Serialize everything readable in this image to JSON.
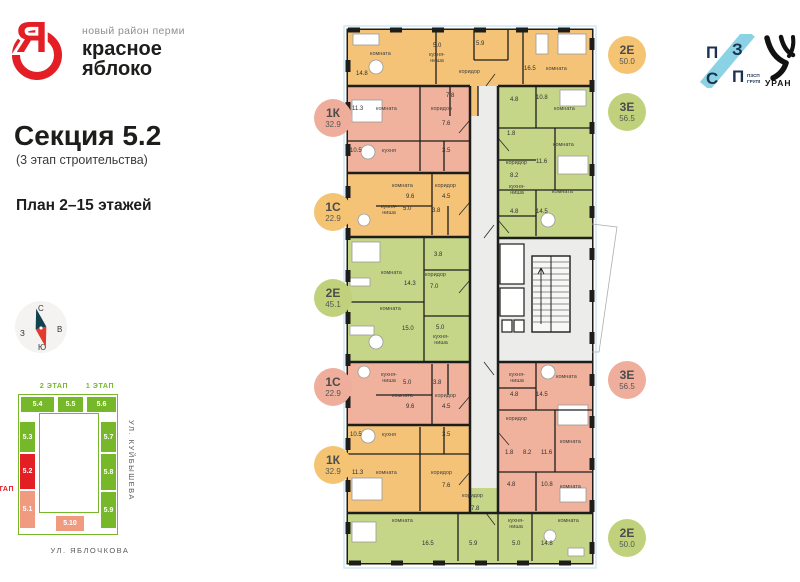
{
  "brand": {
    "logo_letter": "Я",
    "tagline": "новый район перми",
    "name_line1": "красное",
    "name_line2": "яблоко",
    "accent_color": "#e31e24"
  },
  "section": {
    "title": "Секция 5.2",
    "subtitle": "(3 этап строительства)",
    "plan_label": "План 2–15 этажей"
  },
  "compass": {
    "n": "С",
    "e": "В",
    "s": "Ю",
    "w": "З"
  },
  "partners": {
    "pzsp": {
      "tl": "П",
      "tr": "З",
      "bl": "С",
      "br": "П",
      "caption_line1": "ПЗСП",
      "caption_line2": "ГРУПП",
      "band_color": "#8ad2e4",
      "letter_color": "#1c3250"
    },
    "uran": {
      "name": "УРАН"
    }
  },
  "site_plan": {
    "stage2_label": "2 ЭТАП",
    "stage1_label": "1 ЭТАП",
    "stage3_label": "3 ЭТАП",
    "street_right": "УЛ. КУЙБЫШЕВА",
    "street_bottom": "УЛ. ЯБЛОЧКОВА",
    "blocks": [
      {
        "label": "5.4",
        "color": "#76b82a"
      },
      {
        "label": "5.5",
        "color": "#76b82a"
      },
      {
        "label": "5.6",
        "color": "#76b82a"
      },
      {
        "label": "5.3",
        "color": "#76b82a"
      },
      {
        "label": "5.7",
        "color": "#76b82a"
      },
      {
        "label": "5.2",
        "color": "#e31e24"
      },
      {
        "label": "5.8",
        "color": "#76b82a"
      },
      {
        "label": "5.1",
        "color": "#f09a80"
      },
      {
        "label": "5.9",
        "color": "#76b82a"
      },
      {
        "label": "5.10",
        "color": "#f09a80"
      }
    ]
  },
  "badges": {
    "left": [
      {
        "code": "1К",
        "area": "32.9",
        "color": "#efad9b"
      },
      {
        "code": "1С",
        "area": "22.9",
        "color": "#f4c472"
      },
      {
        "code": "2Е",
        "area": "45.1",
        "color": "#bfd27b"
      },
      {
        "code": "1С",
        "area": "22.9",
        "color": "#efad9b"
      },
      {
        "code": "1К",
        "area": "32.9",
        "color": "#f4c472"
      }
    ],
    "right": [
      {
        "code": "2Е",
        "area": "50.0",
        "color": "#f4c472"
      },
      {
        "code": "3Е",
        "area": "56.5",
        "color": "#bfd27b"
      },
      {
        "code": "3Е",
        "area": "56.5",
        "color": "#efad9b"
      },
      {
        "code": "2Е",
        "area": "50.0",
        "color": "#bfd27b"
      }
    ]
  },
  "floor_plan": {
    "colors": {
      "orange": "#f4c377",
      "salmon": "#f0b29c",
      "green": "#c5d689",
      "core": "#ececea"
    },
    "apartments": [
      {
        "code": "2Е",
        "total": "50.0",
        "rooms": [
          {
            "name": "комната",
            "area": "14.8"
          },
          {
            "name": "кухня-ниша",
            "area": "5.0"
          },
          {
            "name": "с/у",
            "area": "5.9"
          },
          {
            "name": "коридор",
            "area": "7.8"
          },
          {
            "name": "комната",
            "area": "16.5"
          }
        ]
      },
      {
        "code": "1К",
        "total": "32.9",
        "rooms": [
          {
            "name": "комната",
            "area": "11.3"
          },
          {
            "name": "коридор",
            "area": "7.6"
          },
          {
            "name": "кухня",
            "area": "10.5"
          },
          {
            "name": "с/у",
            "area": "3.5"
          }
        ]
      },
      {
        "code": "1С",
        "total": "22.9",
        "rooms": [
          {
            "name": "комната",
            "area": "9.6"
          },
          {
            "name": "коридор",
            "area": "4.5"
          },
          {
            "name": "кухня-ниша",
            "area": "5.0"
          },
          {
            "name": "с/у",
            "area": "3.8"
          }
        ]
      },
      {
        "code": "2Е",
        "total": "45.1",
        "rooms": [
          {
            "name": "комната",
            "area": "14.3"
          },
          {
            "name": "с/у",
            "area": "3.8"
          },
          {
            "name": "коридор",
            "area": "7.0"
          },
          {
            "name": "комната",
            "area": "15.0"
          },
          {
            "name": "кухня-ниша",
            "area": "5.0"
          }
        ]
      },
      {
        "code": "1С",
        "total": "22.9",
        "rooms": [
          {
            "name": "кухня-ниша",
            "area": "5.0"
          },
          {
            "name": "с/у",
            "area": "3.8"
          },
          {
            "name": "комната",
            "area": "9.6"
          },
          {
            "name": "коридор",
            "area": "4.5"
          }
        ]
      },
      {
        "code": "1К",
        "total": "32.9",
        "rooms": [
          {
            "name": "кухня",
            "area": "10.5"
          },
          {
            "name": "с/у",
            "area": "3.5"
          },
          {
            "name": "комната",
            "area": "11.3"
          },
          {
            "name": "коридор",
            "area": "7.6"
          }
        ]
      },
      {
        "code": "2Е",
        "total": "50.0",
        "rooms": [
          {
            "name": "комната",
            "area": "16.5"
          },
          {
            "name": "с/у",
            "area": "5.9"
          },
          {
            "name": "коридор",
            "area": "7.8"
          },
          {
            "name": "кухня-ниша",
            "area": "5.0"
          },
          {
            "name": "комната",
            "area": "14.8"
          }
        ]
      },
      {
        "code": "3Е",
        "total": "56.5",
        "rooms": [
          {
            "name": "с/у",
            "area": "4.8"
          },
          {
            "name": "комната",
            "area": "10.8"
          },
          {
            "name": "с/у",
            "area": "1.8"
          },
          {
            "name": "комната",
            "area": "11.6"
          },
          {
            "name": "коридор",
            "area": "8.2"
          },
          {
            "name": "кухня-ниша",
            "area": "4.8"
          },
          {
            "name": "комната",
            "area": "14.5"
          }
        ]
      },
      {
        "code": "3Е",
        "total": "56.5",
        "rooms": [
          {
            "name": "кухня-ниша",
            "area": "4.8"
          },
          {
            "name": "комната",
            "area": "14.5"
          },
          {
            "name": "коридор",
            "area": "8.2"
          },
          {
            "name": "комната",
            "area": "11.6"
          },
          {
            "name": "с/у",
            "area": "1.8"
          },
          {
            "name": "с/у",
            "area": "4.8"
          },
          {
            "name": "комната",
            "area": "10.8"
          }
        ]
      }
    ]
  }
}
